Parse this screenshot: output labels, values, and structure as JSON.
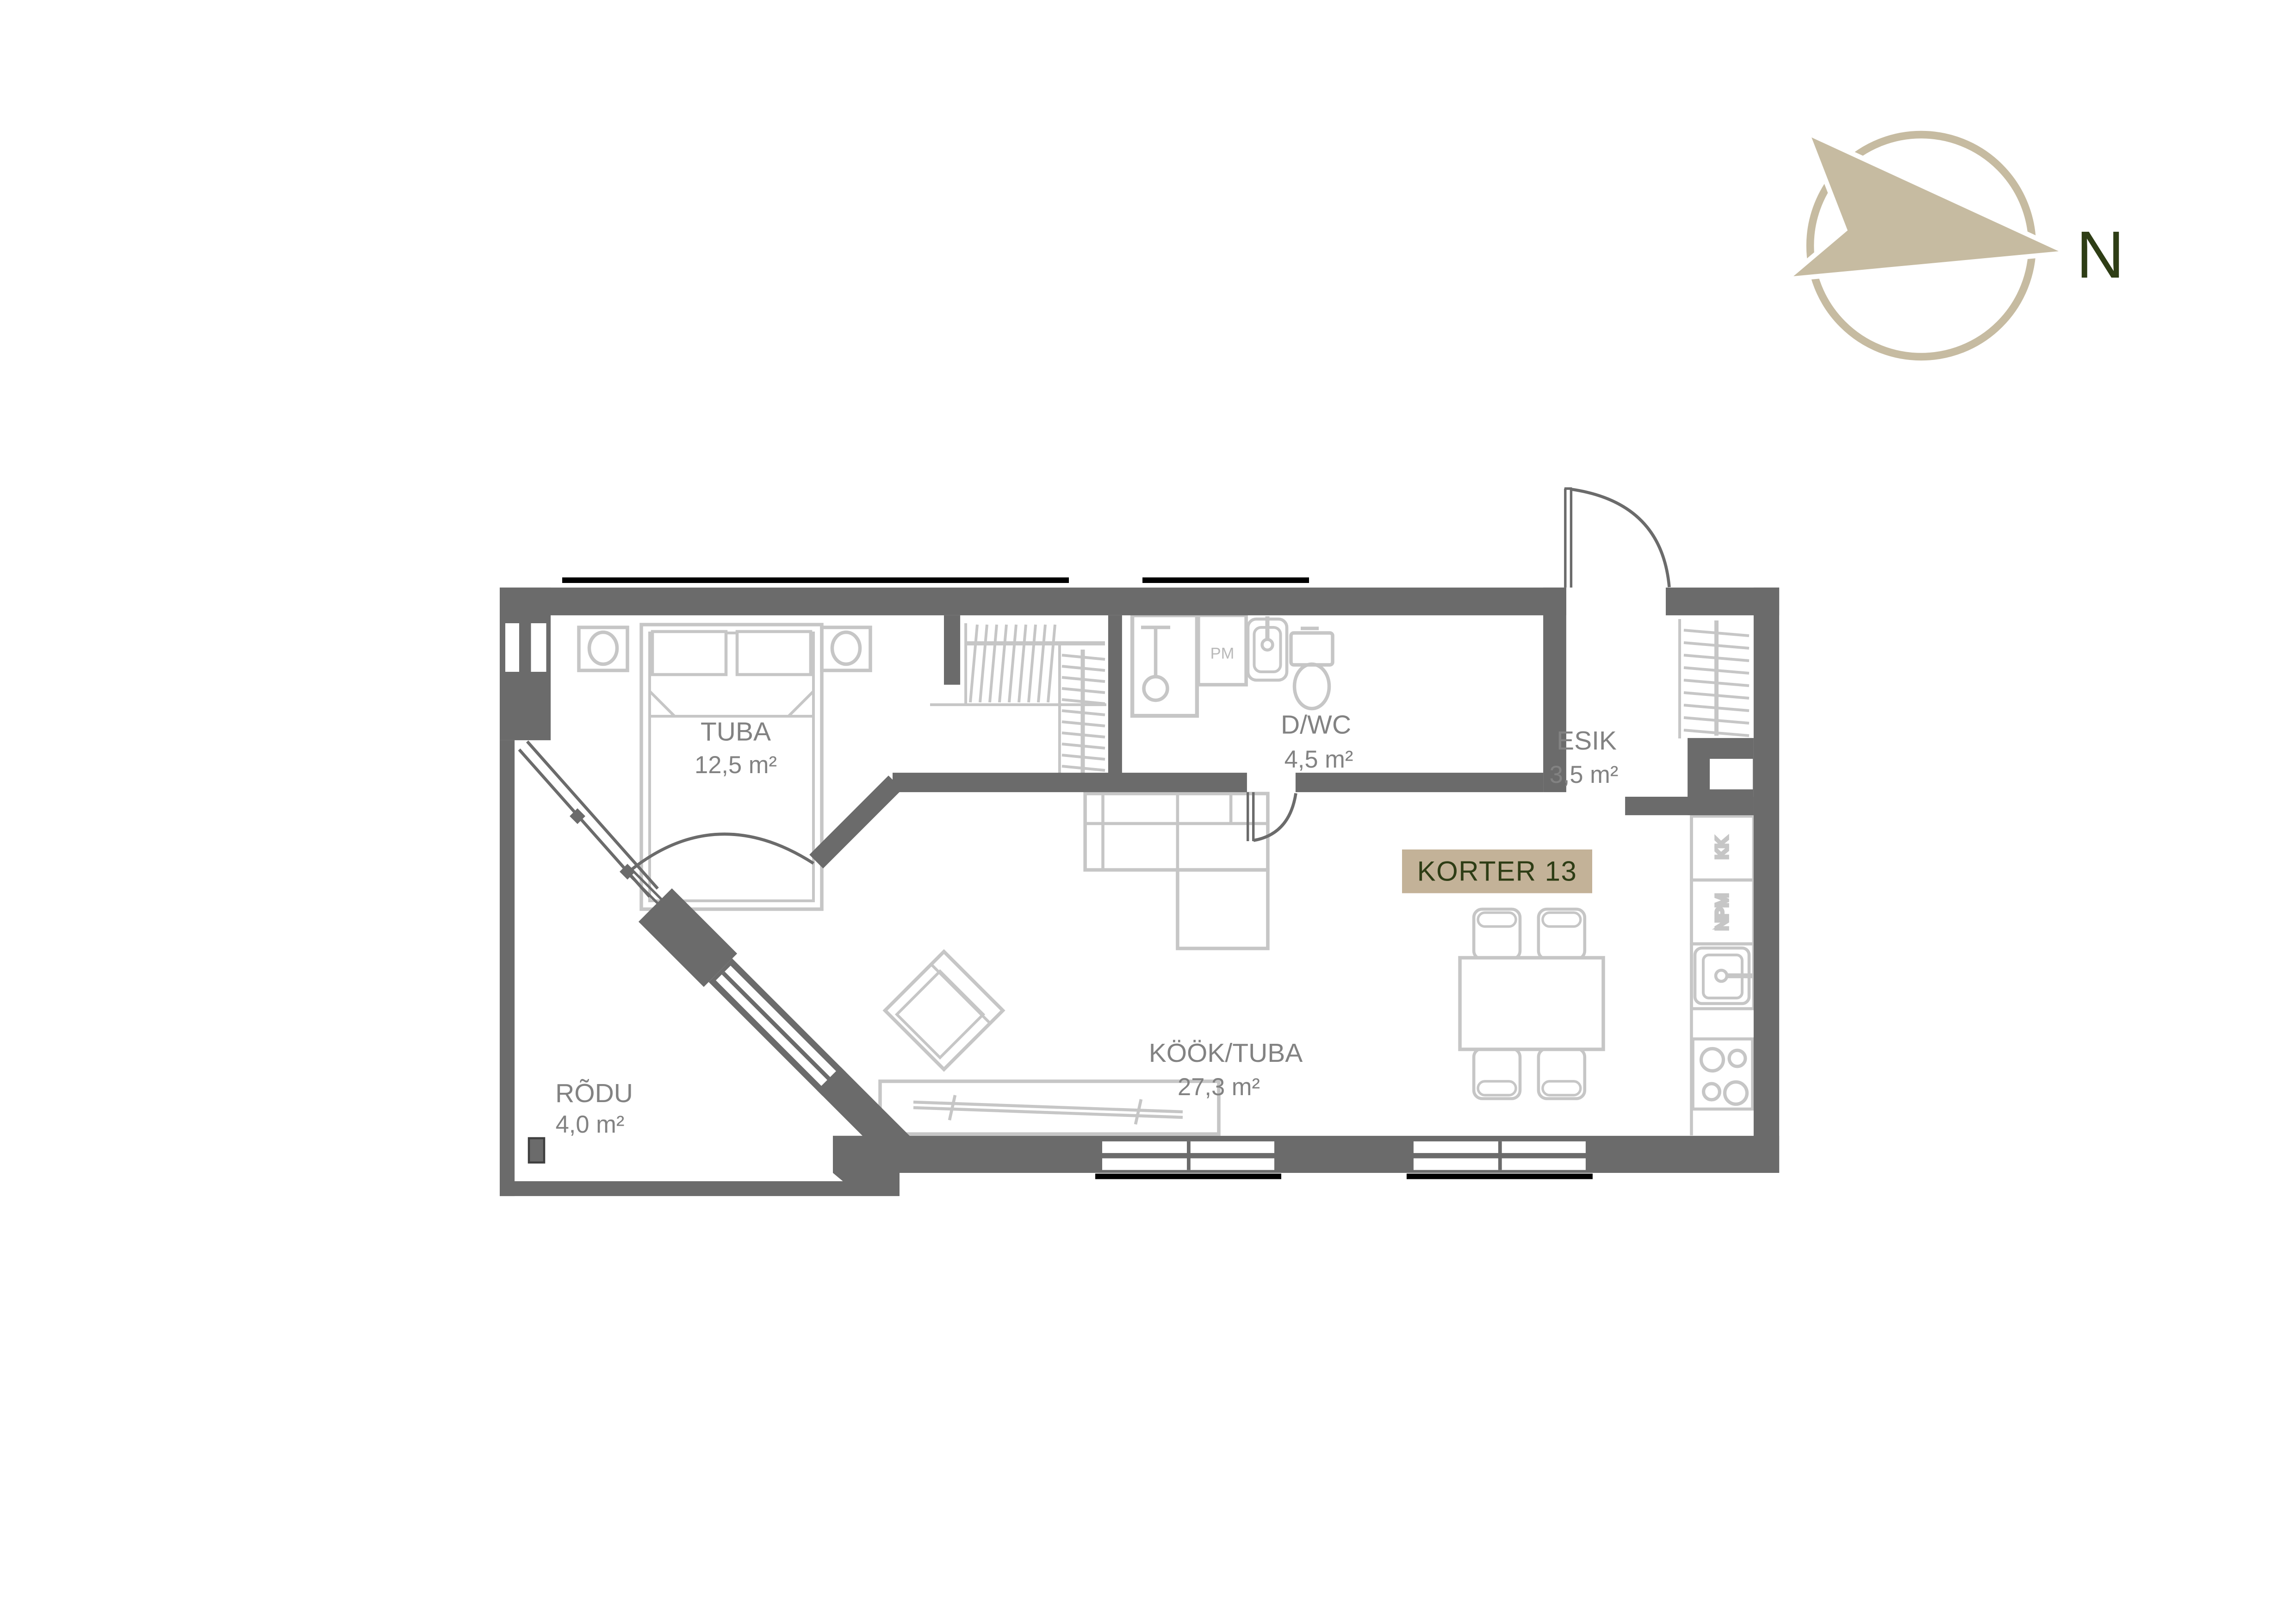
{
  "colors": {
    "wall": "#6b6b6b",
    "furniture": "#c6c6c6",
    "room_label": "#828282",
    "appliance_label": "#b9b9b9",
    "accent_bg": "#c3b298",
    "accent_text": "#2e3d15",
    "compass": "#c6bba1"
  },
  "apartment": {
    "label": "KORTER 13"
  },
  "compass": {
    "north_label": "N"
  },
  "rooms": {
    "tuba": {
      "name": "TUBA",
      "area": "12,5 m²"
    },
    "dwc": {
      "name": "D/WC",
      "area": "4,5 m²"
    },
    "esik": {
      "name": "ESIK",
      "area": "3,5 m²"
    },
    "kook_tuba": {
      "name": "KÖÖK/TUBA",
      "area": "27,3 m²"
    },
    "rodu": {
      "name": "RÕDU",
      "area": "4,0 m²"
    }
  },
  "appliances": {
    "washing_machine": "PM",
    "fridge": "KK",
    "dishwasher": "NPM"
  }
}
